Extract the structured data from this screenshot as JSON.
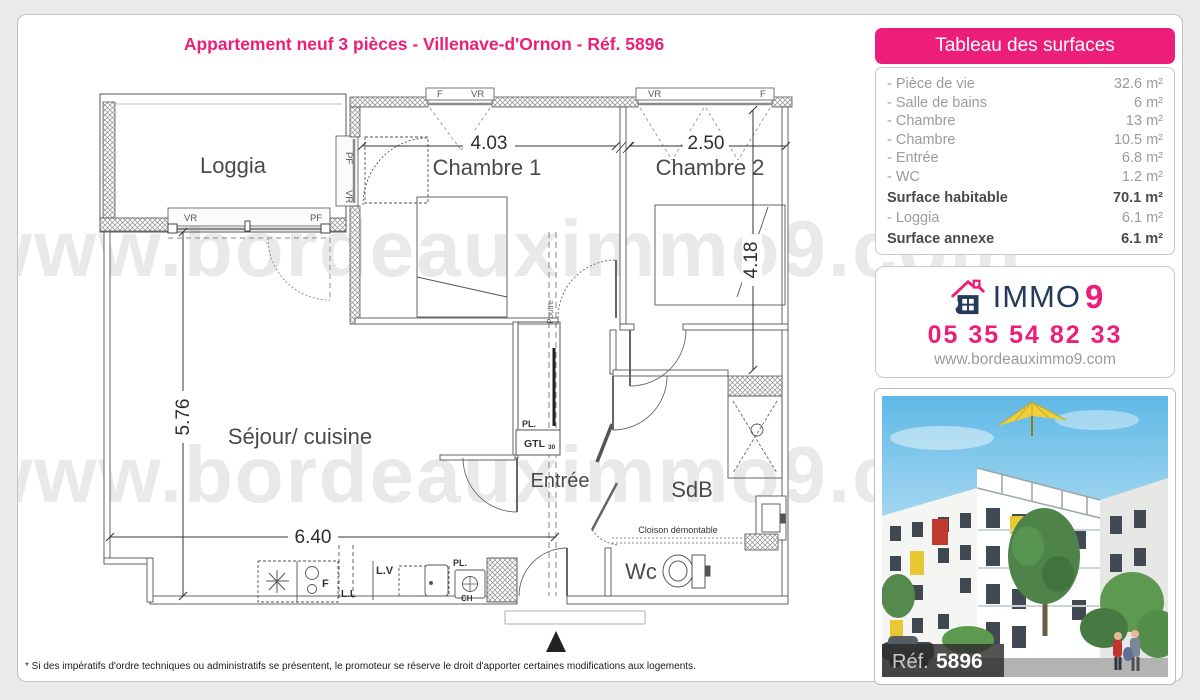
{
  "title": "Appartement neuf 3 pièces - Villenave-d'Ornon - Réf. 5896",
  "watermark": "www.bordeauximmo9.com",
  "surface_table": {
    "header": "Tableau des surfaces",
    "rows": [
      {
        "label": "- Pièce de vie",
        "value": "32.6 m²"
      },
      {
        "label": "- Salle de bains",
        "value": "6 m²"
      },
      {
        "label": "- Chambre",
        "value": "13 m²"
      },
      {
        "label": "- Chambre",
        "value": "10.5 m²"
      },
      {
        "label": "- Entrée",
        "value": "6.8 m²"
      },
      {
        "label": "- WC",
        "value": "1.2 m²"
      },
      {
        "label": "Surface habitable",
        "value": "70.1 m²"
      },
      {
        "label": "- Loggia",
        "value": "6.1 m²"
      },
      {
        "label": "Surface annexe",
        "value": "6.1 m²"
      }
    ]
  },
  "agency": {
    "brand_immo": "IMMO",
    "brand_9": "9",
    "phone": "05 35 54 82 33",
    "website": "www.bordeauximmo9.com"
  },
  "photo": {
    "ref_label": "Réf.",
    "ref_number": "5896"
  },
  "floor_plan": {
    "rooms": {
      "loggia": "Loggia",
      "chambre1": "Chambre 1",
      "chambre2": "Chambre 2",
      "sejour": "Séjour/ cuisine",
      "entree": "Entrée",
      "sdb": "SdB",
      "wc": "Wc"
    },
    "dims": {
      "chambre1_width": "4.03",
      "chambre2_width": "2.50",
      "chambre2_height": "4.18",
      "sejour_height": "5.76",
      "sejour_width": "6.40"
    },
    "labels": {
      "vr": "VR",
      "pf": "PF",
      "f": "F",
      "ll": "L.L",
      "lv": "L.V",
      "pl": "PL.",
      "ch": "CH",
      "gtl": "GTL",
      "gtl_size": "30",
      "poutre": "Poutre",
      "cloison": "Cloison démontable"
    }
  },
  "footnote": "* Si des impératifs d'ordre techniques ou administratifs se présentent, le promoteur se réserve le droit d'apporter certaines modifications aux logements.",
  "colors": {
    "pink": "#ED1E79",
    "navy": "#24395B"
  }
}
